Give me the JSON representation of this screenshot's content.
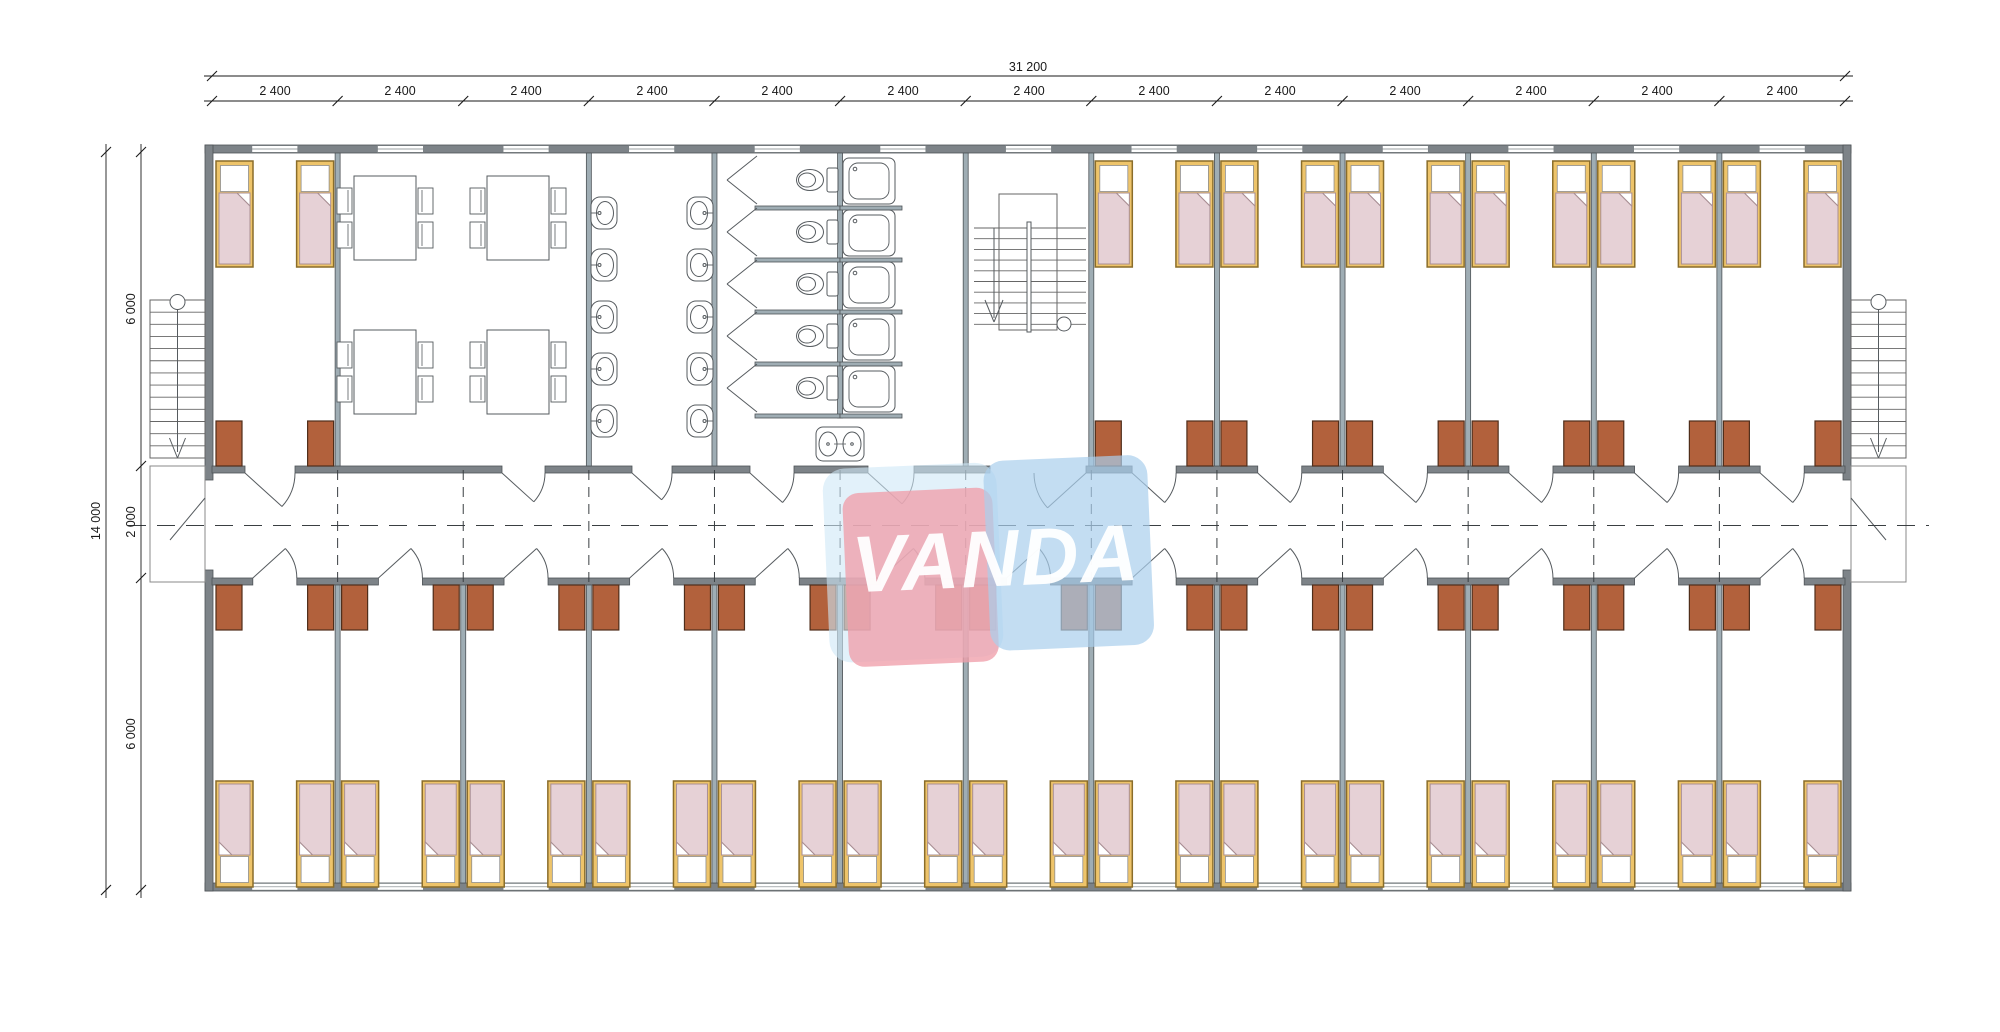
{
  "watermark": {
    "text": "VANDA"
  },
  "dimensions": {
    "total_width": "31 200",
    "top_segments": [
      "2 400",
      "2 400",
      "2 400",
      "2 400",
      "2 400",
      "2 400",
      "2 400",
      "2 400",
      "2 400",
      "2 400",
      "2 400",
      "2 400",
      "2 400"
    ],
    "total_height": "14 000",
    "left_segments": [
      "6 000",
      "2 000",
      "6 000"
    ]
  },
  "colors": {
    "wall": "#7d8388",
    "partition": "#9fadb4",
    "wall_edge": "#4e5357",
    "fixture_stroke": "#565b5f",
    "dash": "#3a3f42",
    "dim": "#1a1a1a",
    "bed_frame": "#eec46a",
    "bed_frame_border": "#8a6d2a",
    "mattress": "#e6d1d6",
    "mattress_border": "#a98f94",
    "pillow": "#ffffff",
    "wardrobe": "#b2613c",
    "wardrobe_border": "#4f2d1a",
    "logo_pink": "#ef9fab",
    "logo_blue": "#a9cfec",
    "logo_halo": "#cfe7f7",
    "logo_text": "#ffffff"
  },
  "fixtures": {
    "beds": 40,
    "wardrobes": 40,
    "dining_tables": 4,
    "dining_chairs": 16,
    "wash_basins": 12,
    "toilet_stalls": 5,
    "shower_stalls": 5,
    "internal_staircases": 1,
    "external_staircases": 2
  }
}
